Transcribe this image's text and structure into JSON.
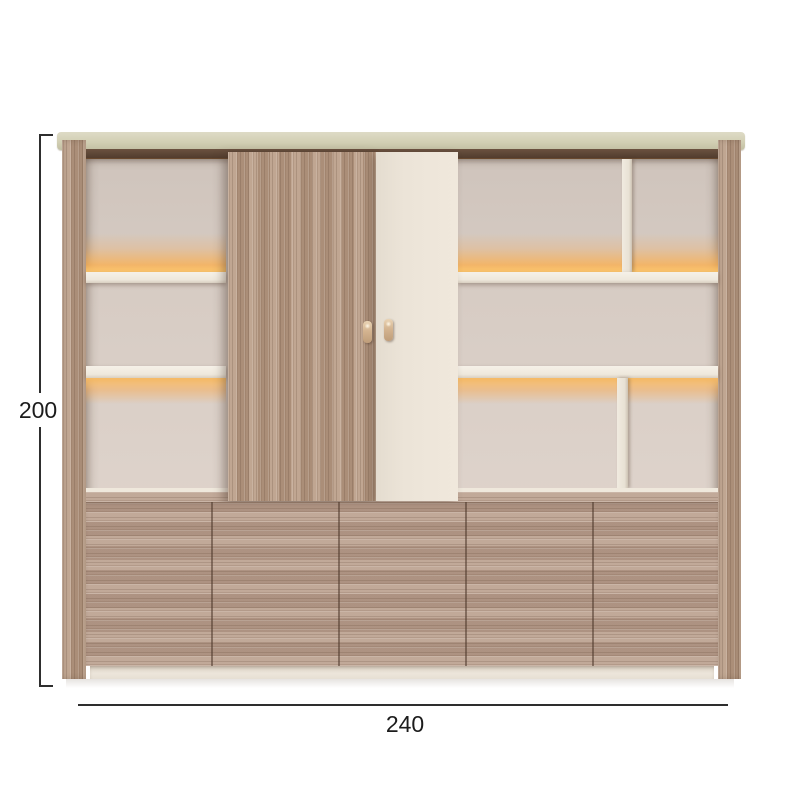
{
  "diagram": {
    "subject": "wardrobe-bookcase-unit",
    "height_dimension": {
      "value": "200"
    },
    "width_dimension": {
      "value": "240"
    },
    "cabinet": {
      "drawer_front_count": 5,
      "sliding_doors": [
        "wood-grain-door",
        "cream-door"
      ],
      "shelf_rows_left": 3,
      "shelf_rows_right": 3,
      "lighting": "warm-led-under-shelf"
    },
    "colors": {
      "background": "#ffffff",
      "wood": "#b2967f",
      "wood_dark_edge": "#533e2f",
      "cream_door": "#ece4d8",
      "interior_back": "#d7ccc4",
      "shelf": "#f2ece2",
      "top_board": "#d2cfb4",
      "led_glow": "#ffa63d",
      "plinth": "#e9e2d6",
      "dimension_line": "#2e2e2e",
      "dimension_text": "#1c1c1c"
    }
  }
}
